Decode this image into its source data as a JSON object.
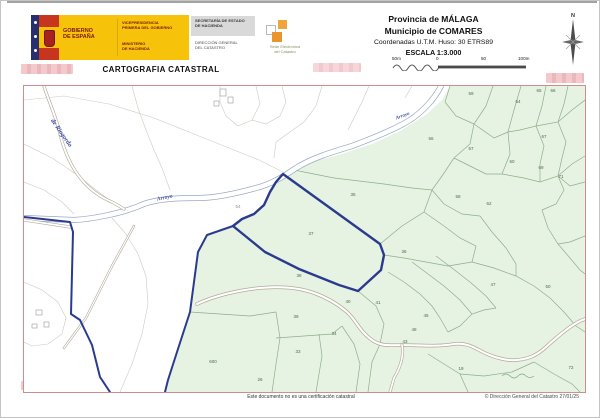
{
  "header": {
    "gobierno_line1": "GOBIERNO",
    "gobierno_line2": "DE ESPAÑA",
    "vice1": "VICEPRESIDENCIA",
    "vice2": "PRIMERA DEL GOBIERNO",
    "min1": "MINISTERIO",
    "min2": "DE HACIENDA",
    "sec1": "SECRETARÍA DE ESTADO",
    "sec2": "DE HACIENDA",
    "dir1": "DIRECCIÓN GENERAL",
    "dir2": "DEL CATASTRO",
    "sede1": "Sede Electrónica",
    "sede2": "del Catastro",
    "title": "CARTOGRAFIA CATASTRAL",
    "provincia": "Provincia de MÁLAGA",
    "municipio": "Municipio de COMARES",
    "coordenadas": "Coordenadas U.T.M. Huso: 30 ETRS89",
    "escala": "ESCALA 1:3.000",
    "scale_labels": [
      "50m",
      "0",
      "50",
      "100m"
    ],
    "compass_n": "N"
  },
  "map": {
    "highlighted_parcel": "37",
    "parcel_numbers": [
      {
        "n": "59",
        "x": 447,
        "y": 9
      },
      {
        "n": "64",
        "x": 494,
        "y": 17
      },
      {
        "n": "65",
        "x": 515,
        "y": 6
      },
      {
        "n": "66",
        "x": 529,
        "y": 6
      },
      {
        "n": "56",
        "x": 407,
        "y": 54
      },
      {
        "n": "57",
        "x": 447,
        "y": 64
      },
      {
        "n": "67",
        "x": 520,
        "y": 52
      },
      {
        "n": "60",
        "x": 488,
        "y": 77
      },
      {
        "n": "69",
        "x": 517,
        "y": 83
      },
      {
        "n": "71",
        "x": 537,
        "y": 92
      },
      {
        "n": "58",
        "x": 434,
        "y": 112
      },
      {
        "n": "62",
        "x": 465,
        "y": 119
      },
      {
        "n": "35",
        "x": 329,
        "y": 110
      },
      {
        "n": "37",
        "x": 287,
        "y": 149
      },
      {
        "n": "36",
        "x": 380,
        "y": 167
      },
      {
        "n": "38",
        "x": 275,
        "y": 191
      },
      {
        "n": "40",
        "x": 324,
        "y": 217
      },
      {
        "n": "41",
        "x": 354,
        "y": 218
      },
      {
        "n": "39",
        "x": 272,
        "y": 232
      },
      {
        "n": "45",
        "x": 402,
        "y": 231
      },
      {
        "n": "48",
        "x": 390,
        "y": 245
      },
      {
        "n": "43",
        "x": 381,
        "y": 257
      },
      {
        "n": "47",
        "x": 469,
        "y": 200
      },
      {
        "n": "50",
        "x": 524,
        "y": 202
      },
      {
        "n": "34",
        "x": 310,
        "y": 249
      },
      {
        "n": "33",
        "x": 274,
        "y": 267
      },
      {
        "n": "600",
        "x": 189,
        "y": 277
      },
      {
        "n": "26",
        "x": 236,
        "y": 295
      },
      {
        "n": "19",
        "x": 437,
        "y": 284
      },
      {
        "n": "72",
        "x": 547,
        "y": 283
      },
      {
        "n": "54",
        "x": 214,
        "y": 122,
        "cls": "pnum gray"
      }
    ],
    "blue_labels": [
      {
        "text": "de Riogordo",
        "x": 36,
        "y": 48,
        "rot": 55,
        "size": 6.5
      },
      {
        "text": "Arroyo",
        "x": 141,
        "y": 113,
        "rot": -12,
        "size": 5.5
      },
      {
        "text": "Arroyo",
        "x": 379,
        "y": 31,
        "rot": -20,
        "size": 5
      }
    ]
  },
  "footer": {
    "disclaimer": "Este documento no es una certificación catastral",
    "copyright": "© Dirección General del Catastro 27/01/25"
  },
  "colors": {
    "navy_boundary": "#2a3b8f",
    "green_zone": "#e6f2e2",
    "map_frame": "#cf8d8d",
    "gov_yellow": "#f6c20a",
    "redaction_pink": "#f3c9cc"
  }
}
